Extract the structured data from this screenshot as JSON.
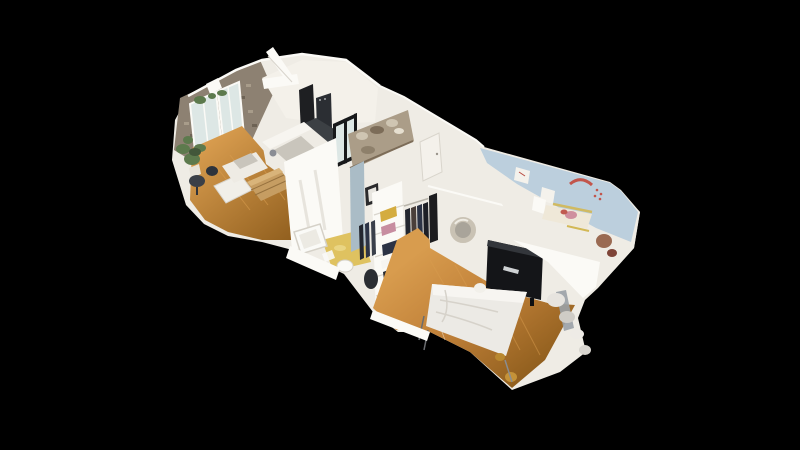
{
  "app": {
    "name": "3D dollhouse apartment scan viewer"
  },
  "viewport": {
    "width": 800,
    "height": 450
  },
  "scene": {
    "type": "dollhouse-3d-scan",
    "description": "Cut-away aerial dollhouse view of a one-bedroom apartment 3D scan floating on a black background, oriented diagonally from the living room at upper left to the bedroom and kids room at lower right.",
    "rooms": [
      {
        "name": "living-room",
        "features": [
          "french-windows",
          "stone-wall",
          "sofa",
          "storage-trunk",
          "desk-and-chairs",
          "house-plant",
          "wood-floor"
        ]
      },
      {
        "name": "kitchen",
        "features": [
          "dark-appliances",
          "countertop",
          "glass-partition"
        ]
      },
      {
        "name": "loft-bed",
        "features": [
          "mezzanine-bedding"
        ]
      },
      {
        "name": "dressing-room",
        "features": [
          "open-wardrobe",
          "hanging-clothes",
          "folded-clothes",
          "framed-picture"
        ]
      },
      {
        "name": "bathroom",
        "features": [
          "bathtub",
          "toilet",
          "yellow-floor"
        ]
      },
      {
        "name": "hallway",
        "features": [
          "rattan-mirror",
          "doorway",
          "door"
        ]
      },
      {
        "name": "bedroom",
        "features": [
          "double-bed",
          "tv-cabinet",
          "wood-floor"
        ]
      },
      {
        "name": "kids-room",
        "features": [
          "rainbow-wall-decal",
          "light-blue-walls",
          "toddler-bed"
        ]
      }
    ]
  },
  "palette": {
    "background": "#000000",
    "wall_white": "#efece5",
    "wall_bright": "#fbfaf6",
    "wall_shadow": "#d9d5cd",
    "wood_light": "#d89c4e",
    "wood_mid": "#c08038",
    "wood_dark": "#92601f",
    "stone": "#8d8172",
    "stone_light": "#a89c8a",
    "stone_dark": "#6e6355",
    "glass": "#dde7e5",
    "plant_green": "#5d7a4d",
    "plant_dark": "#42573a",
    "sofa_white": "#eeebe4",
    "cushion_grey": "#c9c5bc",
    "trunk_wood": "#c69d62",
    "trunk_light": "#d9b47a",
    "trunk_dark": "#96713e",
    "appliance_dark": "#1e1f22",
    "appliance_mid": "#2b2e33",
    "counter_dark": "#3c4044",
    "partition_black": "#17181a",
    "loft_blanket": "#ab9d88",
    "loft_light": "#cfc5b2",
    "loft_dark": "#7c6c58",
    "dressing_wall": "#aabcc6",
    "clothes_yellow": "#d4ac3f",
    "clothes_pink": "#c78da0",
    "clothes_navy": "#2c3345",
    "clothes_dark": "#23262e",
    "bath_yellow": "#dfc260",
    "fixture_white": "#fafaf7",
    "mirror_rattan": "#c9c2b4",
    "tv_dark": "#141518",
    "tv_glint": "#cfd2d4",
    "bed_white": "#eceae5",
    "bed_fold": "#d6d2ca",
    "kids_wall": "#bccfdd",
    "rainbow_red": "#c2554b",
    "kids_yellow": "#d3b855",
    "kids_pink": "#cf8f9e",
    "kids_brown": "#9a6a52",
    "steel_grey": "#9aa1a6",
    "doorway_dark": "#1c1c1e",
    "chair_dark": "#3a3f47",
    "pot_red": "#8f4a2c"
  }
}
